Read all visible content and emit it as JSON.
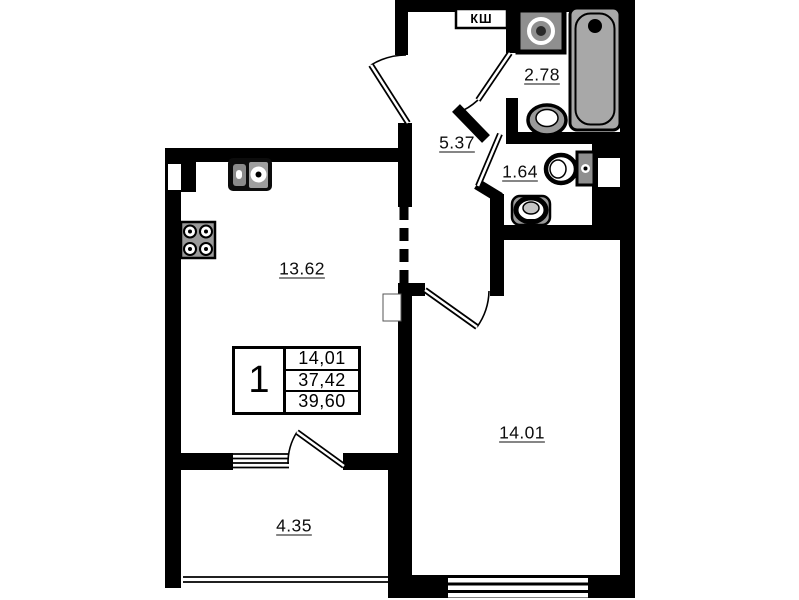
{
  "plan": {
    "shaft_label": "КШ",
    "labels": {
      "kitchen": "13.62",
      "hallway": "5.37",
      "bathroom": "2.78",
      "toilet": "1.64",
      "living_room": "14.01",
      "balcony": "4.35"
    },
    "rooms": [
      {
        "id": "kitchen",
        "area": "13.62"
      },
      {
        "id": "hallway",
        "area": "5.37"
      },
      {
        "id": "bathroom",
        "area": "2.78"
      },
      {
        "id": "toilet",
        "area": "1.64"
      },
      {
        "id": "living-room",
        "area": "14.01"
      },
      {
        "id": "balcony",
        "area": "4.35"
      }
    ]
  },
  "info_table": {
    "unit_number": "1",
    "living_area": "14,01",
    "apartment_area": "37,42",
    "total_area": "39,60"
  },
  "colors": {
    "wall": "#000000",
    "fixture_fill": "#a8a8a8",
    "background": "#ffffff"
  }
}
